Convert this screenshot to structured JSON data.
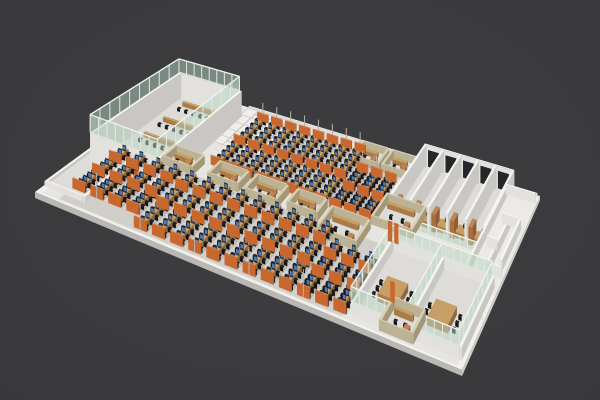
{
  "scene": {
    "canvas": {
      "width": 600,
      "height": 400
    },
    "background": {
      "center": "#3d3d3f",
      "mid": "#3a3a3c",
      "edge": "#333335"
    },
    "floor": {
      "corners": {
        "left": [
          35,
          192
        ],
        "bottom": [
          462,
          370
        ],
        "top": [
          178,
          86
        ],
        "right": [
          540,
          196
        ]
      },
      "bandInset": 0.013,
      "slabThickness": 6
    },
    "palette": {
      "floorBand": "#f2f1ed",
      "floorMain": "#e6e5e1",
      "roomFloor": "#dedcd8",
      "slabFront": "#b9b8b5",
      "slabSide": "#ccccc8",
      "whiteWall": {
        "top": "#f5f4f1",
        "front": "#e2e1dd",
        "side": "#c8c7c3"
      },
      "beigeWall": {
        "top": "#d8cfb4",
        "front": "#bcb296",
        "side": "#a29878"
      },
      "wood": {
        "top": "#c79e66",
        "front": "#a87c49",
        "side": "#8f6a3f"
      },
      "woodDoor": {
        "top": "#c08553",
        "front": "#aa6f3e",
        "side": "#8f5c33"
      },
      "orange": {
        "top": "#dd8248",
        "front": "#c8682f",
        "side": "#9e4f1f"
      },
      "chair": "#1d1d20",
      "chairFront": "#141416",
      "monitor": "#26282c",
      "screen": "#4a7cc2",
      "glassFill": "rgba(185,214,197,0.5)",
      "glassPost": "#dfe8dd",
      "roofRim": "#f2f2ef",
      "pole": "#b3b2af",
      "tileLine": "#c9c8c4",
      "tileFloor": "#efeeea",
      "mazeFloor": "#eceae6",
      "darkOpening": "#27272a",
      "rowShadow": "rgba(0,0,0,0.10)",
      "bankTint": "rgba(125,120,112,0.20)"
    },
    "zones": {
      "reception": {
        "s0": 0.004,
        "s1": 0.092,
        "t0": 0.06,
        "t1": 0.93,
        "wallH": 6
      },
      "trainingRoom": {
        "s0": 0.03,
        "s1": 0.195,
        "t0": 0.3,
        "t1": 0.93,
        "wallH": 36,
        "glassH": 56,
        "postStepS": 0.022,
        "postStepT": 0.07,
        "chairRows": 4,
        "chairCols": 6,
        "doors": [
          {
            "s": 0.118,
            "w": 0.013,
            "h": 24
          },
          {
            "s": 0.136,
            "w": 0.013,
            "h": 24
          }
        ]
      },
      "lobbyTiles": {
        "s0": 0.195,
        "s1": 0.335,
        "t0": 0.72,
        "t1": 0.995,
        "cols": 5,
        "rows": 5
      },
      "deskBankFront": {
        "s0": 0.065,
        "rowStep": 0.0427,
        "rows": 16,
        "t0": 0.035,
        "t1": 0.46,
        "shortRows": 4,
        "shortT0": 0.115,
        "shortTailFrom": 13,
        "tailT1": 0.375,
        "seats": 11,
        "panels": [
          0,
          0.42,
          0.78
        ],
        "poleEvery": 3,
        "poleH": 26
      },
      "deskBankBack": {
        "s0": 0.255,
        "rowStep": 0.038,
        "rows": 11,
        "t0": 0.575,
        "t1": 0.945,
        "shortTailFrom": 8,
        "tailT1": 0.835,
        "seats": 10,
        "panels": [
          0,
          0.5
        ],
        "backPanel": true,
        "poleEvery": 1,
        "poleH": 26
      },
      "midPods": [
        {
          "s": 0.15,
          "t": 0.47,
          "ds": 0.072,
          "dt": 0.095
        },
        {
          "s": 0.265,
          "t": 0.47,
          "ds": 0.072,
          "dt": 0.095
        },
        {
          "s": 0.36,
          "t": 0.46,
          "ds": 0.078,
          "dt": 0.105
        },
        {
          "s": 0.465,
          "t": 0.47,
          "ds": 0.072,
          "dt": 0.095
        }
      ],
      "rightPods": [
        {
          "s": 0.56,
          "t": 0.39,
          "ds": 0.095,
          "dt": 0.145
        },
        {
          "s": 0.655,
          "t": 0.56,
          "ds": 0.1,
          "dt": 0.15
        }
      ],
      "backPods": [
        {
          "s": 0.52,
          "t": 0.865,
          "ds": 0.068,
          "dt": 0.1
        },
        {
          "s": 0.6,
          "t": 0.865,
          "ds": 0.068,
          "dt": 0.1
        }
      ],
      "meetingRooms": {
        "s0": 0.73,
        "s1": 0.985,
        "t0": 0.045,
        "t1": 0.465,
        "divider": 0.858,
        "lowH": 12,
        "glassH": 26,
        "tables": [
          {
            "s": 0.765,
            "t": 0.17,
            "ds": 0.05,
            "dt": 0.11
          },
          {
            "s": 0.888,
            "t": 0.15,
            "ds": 0.05,
            "dt": 0.11
          }
        ]
      },
      "privateOffices": {
        "s0": 0.69,
        "s1": 0.93,
        "t0": 0.615,
        "t1": 0.965,
        "rooms": 5,
        "wallH": 30,
        "railH": 10
      },
      "coreMaze": {
        "s0": 0.915,
        "s1": 0.998,
        "t0": 0.42,
        "t1": 0.96,
        "wallH": 12,
        "segments": [
          {
            "d": "t",
            "s": 0.915,
            "t0": 0.44,
            "t1": 0.96
          },
          {
            "d": "s",
            "t": 0.955,
            "s0": 0.915,
            "s1": 0.996
          },
          {
            "d": "s",
            "t": 0.44,
            "s0": 0.915,
            "s1": 0.975
          },
          {
            "d": "t",
            "s": 0.958,
            "t0": 0.52,
            "t1": 0.8
          },
          {
            "d": "s",
            "t": 0.655,
            "s0": 0.932,
            "s1": 0.958
          },
          {
            "d": "s",
            "t": 0.8,
            "s0": 0.94,
            "s1": 0.985
          },
          {
            "d": "t",
            "s": 0.985,
            "t0": 0.56,
            "t1": 0.8
          },
          {
            "d": "s",
            "t": 0.52,
            "s0": 0.958,
            "s1": 0.996
          }
        ]
      },
      "rightWalls": [
        {
          "d": "s",
          "t": 0.28,
          "s0": 0.93,
          "s1": 0.995,
          "h": 26
        },
        {
          "d": "t",
          "s": 0.93,
          "t0": 0.28,
          "t1": 0.465,
          "h": 26
        }
      ],
      "smallPod": {
        "s": 0.8,
        "t": 0.025,
        "ds": 0.075,
        "dt": 0.145,
        "wallH": 10
      },
      "corridorDoors": [
        {
          "s": 0.712,
          "t": 0.505,
          "w": 0.011,
          "h": 22
        },
        {
          "s": 0.728,
          "t": 0.505,
          "w": 0.011,
          "h": 22
        },
        {
          "s": 0.79,
          "t": 0.195,
          "w": 0.011,
          "h": 20
        }
      ],
      "curbs": [
        {
          "d": "s",
          "t": 0.985,
          "s0": 0.2,
          "s1": 0.995,
          "h": 5
        },
        {
          "d": "t",
          "s": 0.002,
          "t0": 0.06,
          "t1": 0.93,
          "h": 5
        }
      ],
      "bankTints": [
        {
          "s0": 0.05,
          "s1": 0.715,
          "t0": 0.02,
          "t1": 0.475
        },
        {
          "s0": 0.245,
          "s1": 0.65,
          "t0": 0.565,
          "t1": 0.95
        }
      ]
    }
  }
}
